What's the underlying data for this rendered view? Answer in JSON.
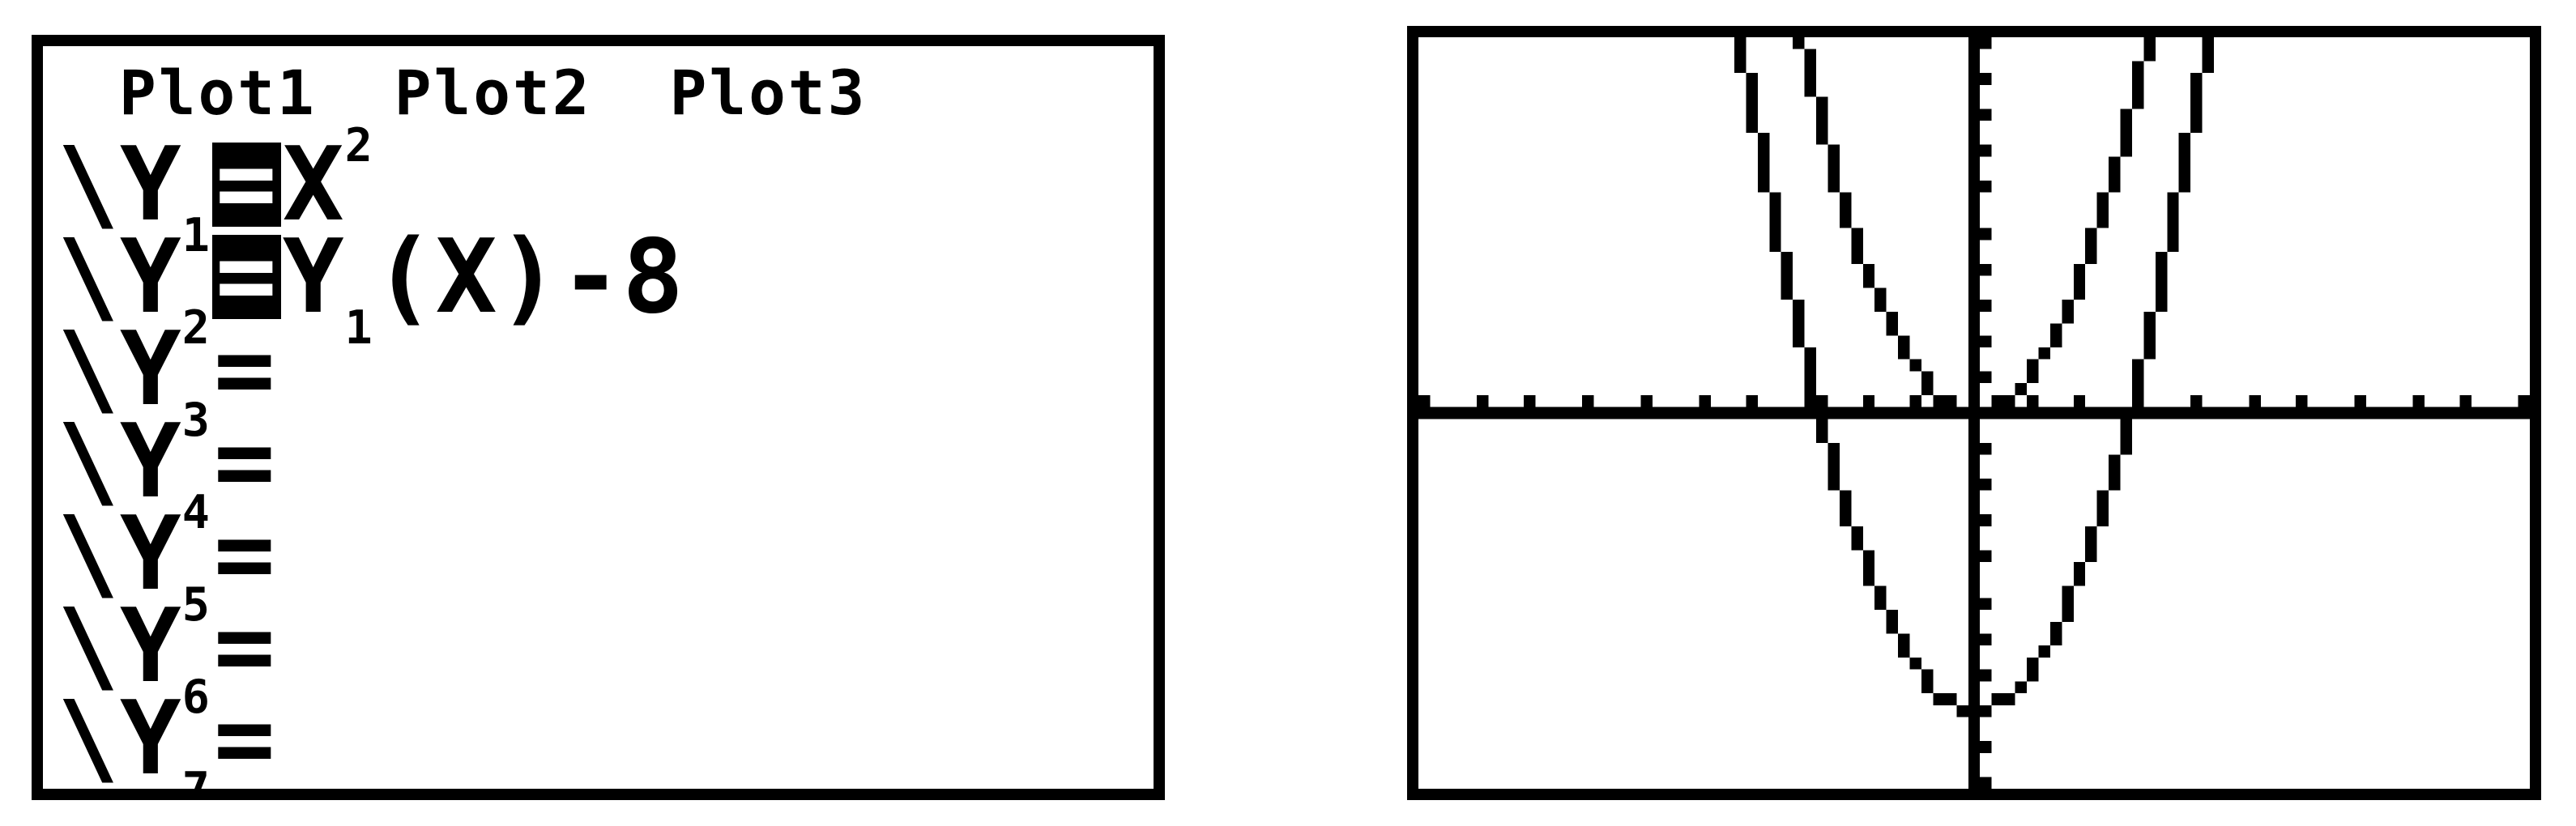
{
  "colors": {
    "foreground": "#000000",
    "background": "#ffffff"
  },
  "left_screen": {
    "header_tabs": [
      "Plot1",
      "Plot2",
      "Plot3"
    ],
    "rows": [
      {
        "style_icon": "\\",
        "label": "Y_1",
        "eq": "=",
        "selected": true,
        "expr": "X^2"
      },
      {
        "style_icon": "\\",
        "label": "Y_2",
        "eq": "=",
        "selected": true,
        "expr": "Y_1(X)-8"
      },
      {
        "style_icon": "\\",
        "label": "Y_3",
        "eq": "=",
        "selected": false,
        "expr": ""
      },
      {
        "style_icon": "\\",
        "label": "Y_4",
        "eq": "=",
        "selected": false,
        "expr": ""
      },
      {
        "style_icon": "\\",
        "label": "Y_5",
        "eq": "=",
        "selected": false,
        "expr": ""
      },
      {
        "style_icon": "\\",
        "label": "Y_6",
        "eq": "=",
        "selected": false,
        "expr": ""
      },
      {
        "style_icon": "\\",
        "label": "Y_7",
        "eq": "=",
        "selected": false,
        "expr": ""
      }
    ]
  },
  "chart_data": {
    "type": "line",
    "title": "",
    "xlabel": "",
    "ylabel": "",
    "grid": false,
    "legend": "none",
    "window": {
      "xmin": -10,
      "xmax": 10,
      "xscl": 1,
      "ymin": -10,
      "ymax": 10,
      "yscl": 1
    },
    "axes": {
      "x_axis": true,
      "y_axis": true,
      "tick_style": "unit ticks on both axes"
    },
    "series": [
      {
        "name": "Y1",
        "equation": "Y1=X^2",
        "poly": [
          0,
          0,
          1
        ],
        "x": [
          -4,
          -3,
          -2,
          -1,
          0,
          1,
          2,
          3,
          4
        ],
        "y": [
          16,
          9,
          4,
          1,
          0,
          1,
          4,
          9,
          16
        ]
      },
      {
        "name": "Y2",
        "equation": "Y2=Y1(X)-8",
        "poly": [
          -8,
          0,
          1
        ],
        "x": [
          -4,
          -3,
          -2,
          -1,
          0,
          1,
          2,
          3,
          4
        ],
        "y": [
          8,
          1,
          -4,
          -7,
          -8,
          -7,
          -4,
          1,
          8
        ]
      }
    ]
  }
}
